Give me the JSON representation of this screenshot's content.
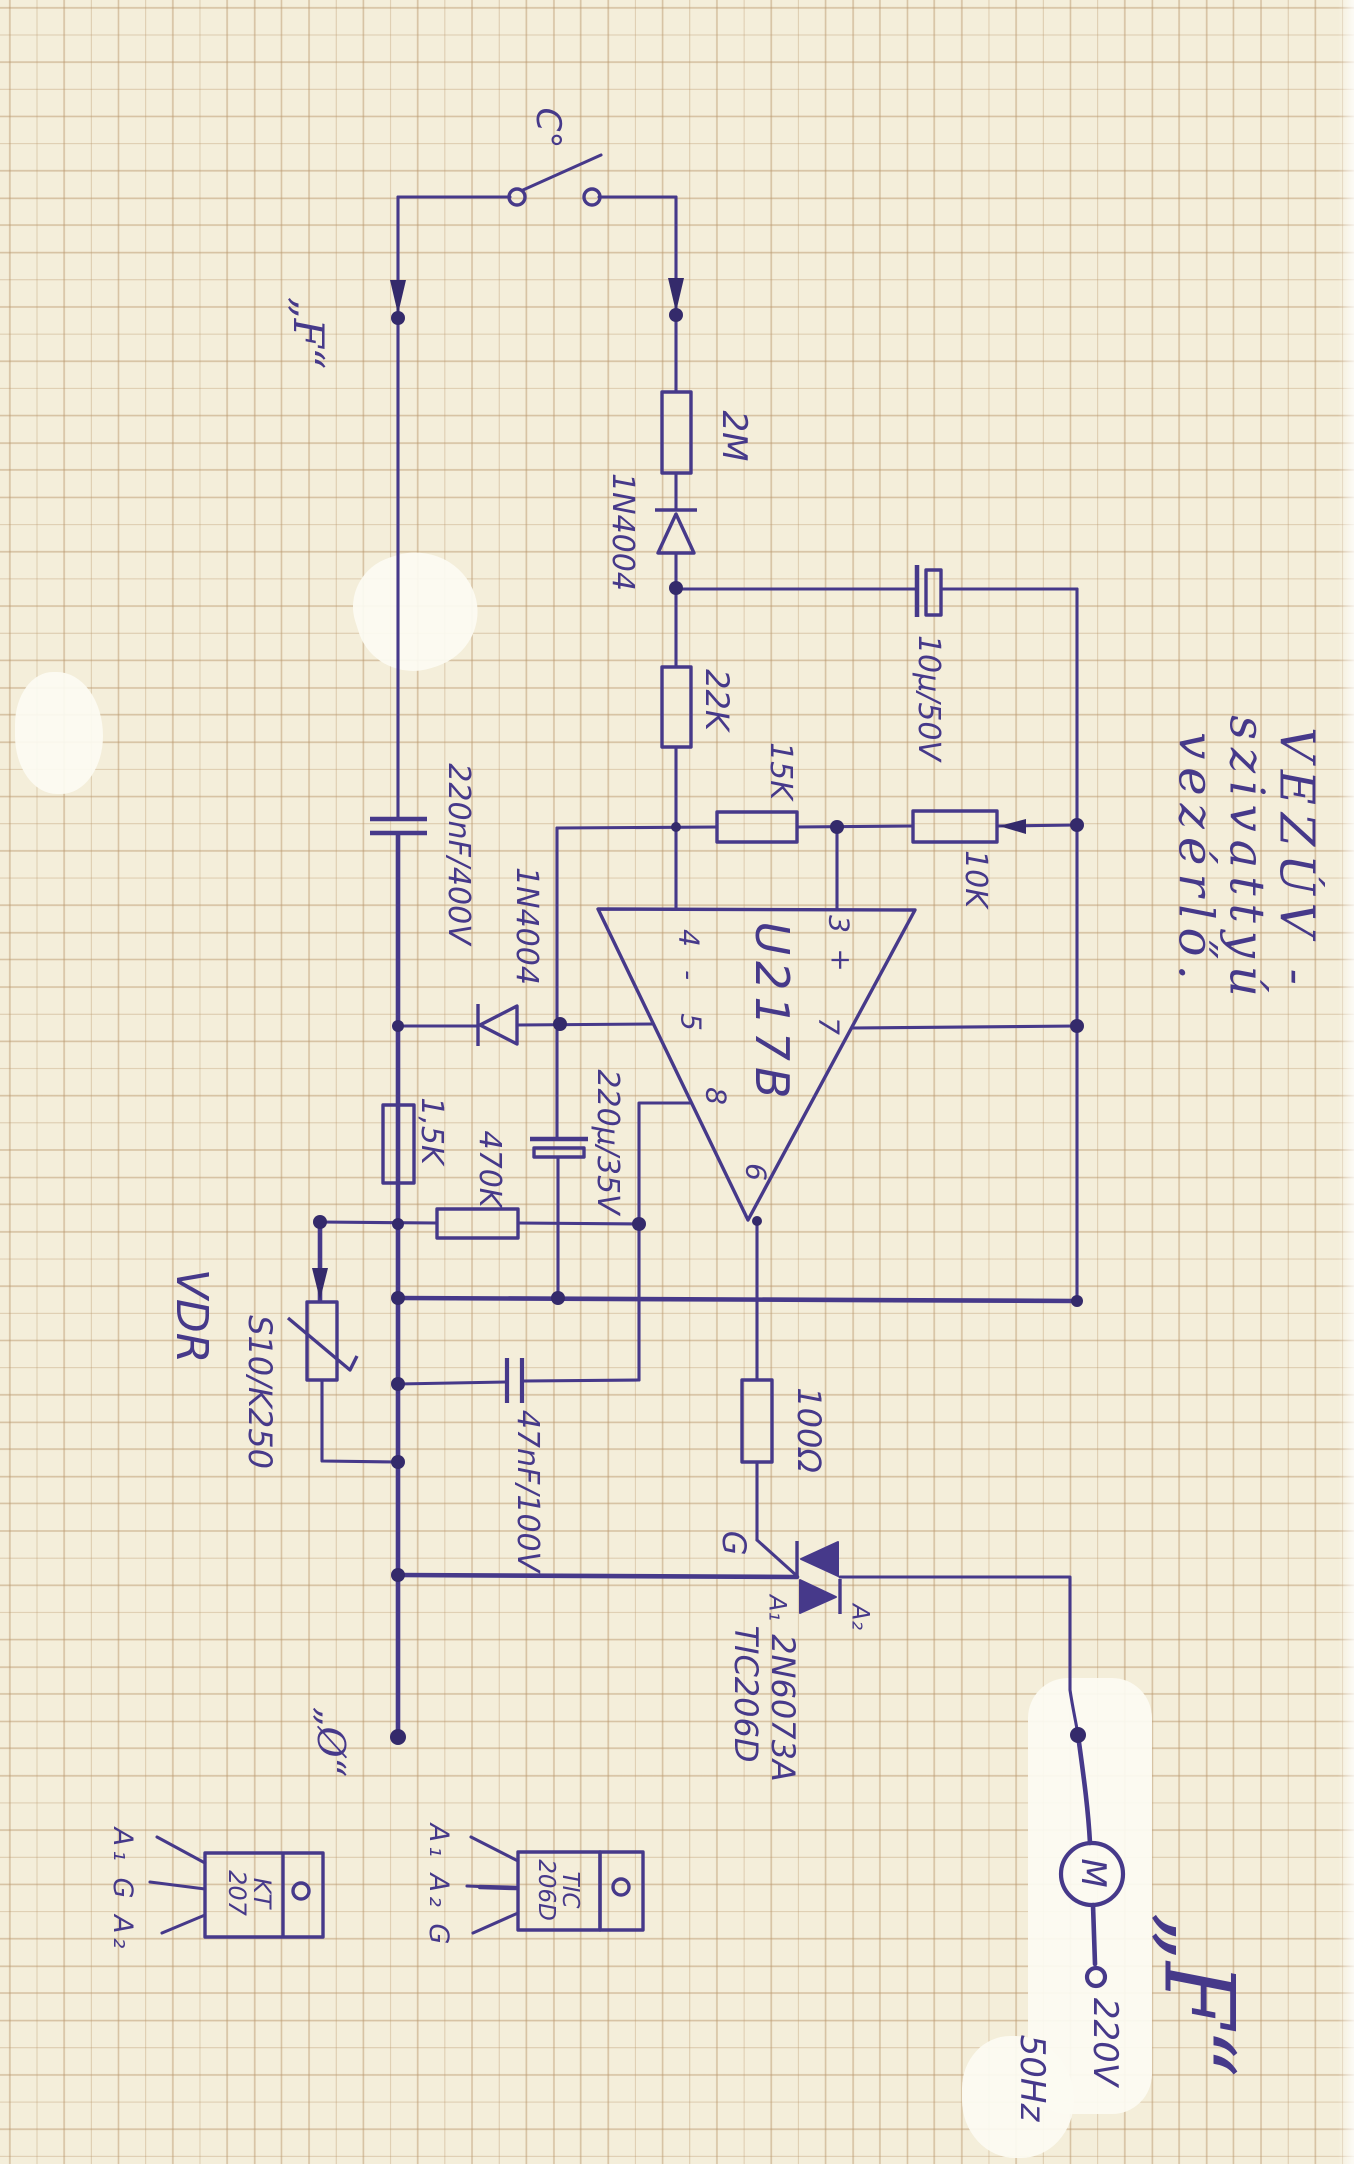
{
  "colors": {
    "paper": "#f4eeda",
    "grid": "rgba(186,152,110,.5)",
    "ink": "#46398a",
    "ink-dark": "#342a6b",
    "wo": "#fcfbf2"
  },
  "title": "VEZÚV - szivattyú vezérlő.",
  "labels": {
    "temp_switch": "C°",
    "phase_top": "„F“",
    "r_2m": "2M",
    "d1": "1N4004",
    "r_22k": "22K",
    "c_10u": "10μ/50V",
    "r_15k": "15K",
    "r_10k": "10K",
    "c_220nf": "220nF/400V",
    "d2": "1N4004",
    "ic": "U217B",
    "pin4": "4",
    "pin_minus": "-",
    "pin5": "5",
    "pin3": "3",
    "pin_plus": "+",
    "pin7": "7",
    "pin8": "8",
    "pin6": "6",
    "c_220u": "220μ/35V",
    "r_470k": "470K",
    "r_1k5": "1,5K",
    "vdr_name": "VDR",
    "vdr_type": "S10/K250",
    "c_47nf": "47nF/100V",
    "r_100": "100Ω",
    "gate": "G",
    "a1": "A₁",
    "a2": "A₂",
    "triac_type1": "TIC206D",
    "triac_type2": "2N6073A",
    "neutral_bottom": "„Ø“",
    "pkg1_pins": "A₁ G A₂",
    "pkg1_type": "KT\n207",
    "pkg2_pins": "A₁ A₂ G",
    "pkg2_type": "TIC\n206D",
    "motor": "M",
    "mains_voltage": "220V",
    "mains_freq": "50Hz",
    "phase_bottom": "„F“"
  }
}
